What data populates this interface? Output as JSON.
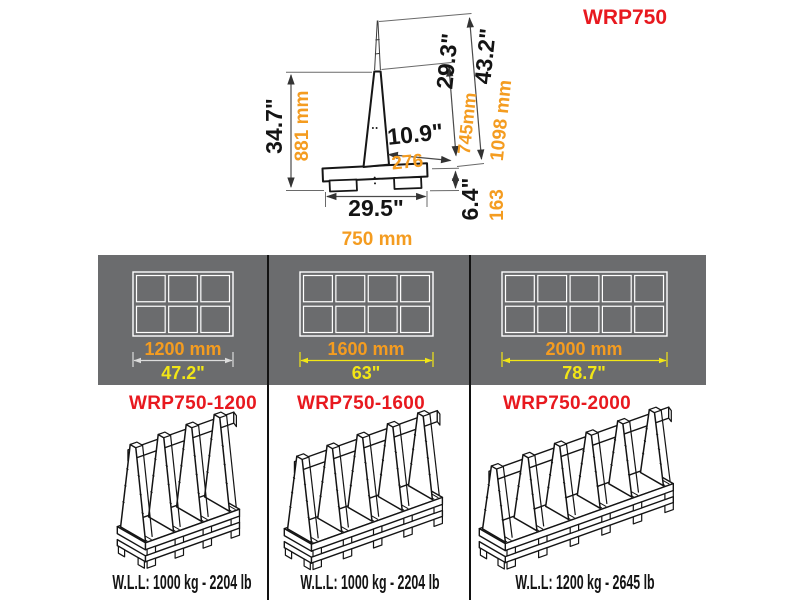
{
  "title": "WRP750",
  "colors": {
    "accent_red": "#e8191f",
    "dim_orange": "#f49c20",
    "dim_yellow": "#f2e616",
    "band_gray": "#6b6c6e",
    "line_black": "#161616",
    "dim_white": "#dcdcdc"
  },
  "cross_section": {
    "dims": {
      "height_in": "34.7\"",
      "height_mm": "881 mm",
      "slant_total_in": "43.2\"",
      "slant_total_mm": "1098 mm",
      "slant_in": "29.3\"",
      "slant_mm": "745mm",
      "ledge_in": "10.9\"",
      "ledge_mm": "276",
      "base_height_in": "6.4\"",
      "base_height_mm": "163",
      "base_width_in": "29.5\"",
      "base_width_mm": "750 mm"
    }
  },
  "top_views": [
    {
      "width_mm": "1200 mm",
      "width_in": "47.2\"",
      "cols": 3,
      "dim_color": "#dcdcdc"
    },
    {
      "width_mm": "1600 mm",
      "width_in": "63\"",
      "cols": 4,
      "dim_color": "#f2e616"
    },
    {
      "width_mm": "2000 mm",
      "width_in": "78.7\"",
      "cols": 5,
      "dim_color": "#f2e616"
    }
  ],
  "models": [
    {
      "name": "WRP750-1200",
      "wll": "W.L.L: 1000 kg - 2204 lb",
      "uprights": 4
    },
    {
      "name": "WRP750-1600",
      "wll": "W.L.L: 1000 kg - 2204 lb",
      "uprights": 5
    },
    {
      "name": "WRP750-2000",
      "wll": "W.L.L: 1200 kg - 2645 lb",
      "uprights": 6
    }
  ]
}
